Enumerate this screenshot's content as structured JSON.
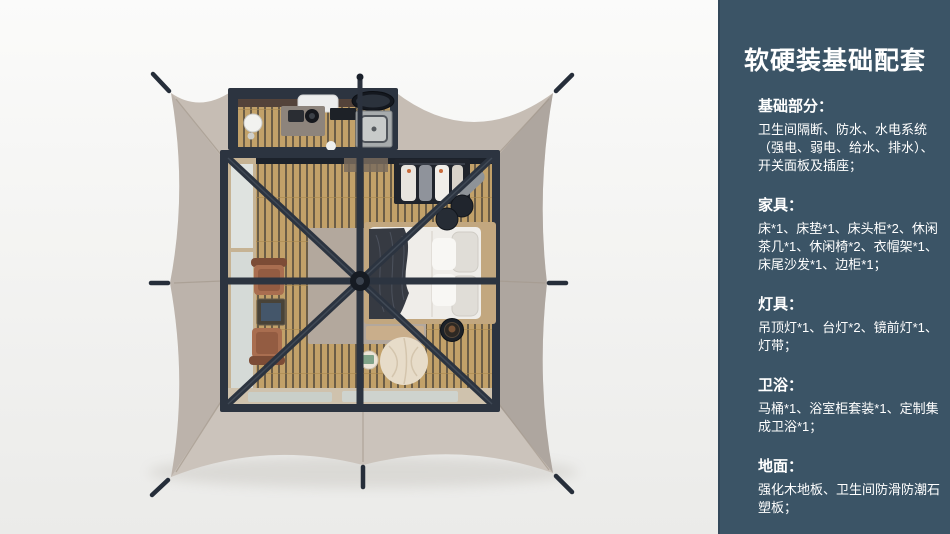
{
  "colors": {
    "sidebar_bg": "#3b5466",
    "sidebar_text": "#ffffff",
    "page_bg_top": "#fbfbfa",
    "page_bg_bottom": "#ebebe9",
    "canopy": "#c6bdb4",
    "canopy_shade": "#a9a09d",
    "frame": "#2c3440",
    "wood_floor": "#c2a169",
    "rug": "#b3a89d",
    "bed": "#efede9",
    "chair": "#a96e50",
    "pouf": "#e7dcc9",
    "glass": "#d8dedb",
    "stake": "#262e3a"
  },
  "scene": {
    "type": "top-down 3d floor plan rendering of a safari glamping tent",
    "elements": [
      "tent-canopy",
      "guy-line-stakes",
      "bathroom-annex",
      "main-room",
      "bed",
      "clothes-rack",
      "lounge-chairs",
      "tea-table",
      "bean-bag-pouf",
      "side-tables",
      "rug",
      "wood-slat-floor",
      "entrance-mats",
      "frame-beams",
      "center-pole"
    ]
  },
  "sidebar": {
    "title": "软硬装基础配套",
    "sections": [
      {
        "heading": "基础部分：",
        "body": [
          "卫生间隔断、防水、水电系统",
          "（强电、弱电、给水、排水）、",
          "开关面板及插座；"
        ]
      },
      {
        "heading": "家具：",
        "body": [
          "床*1、床垫*1、床头柜*2、休闲",
          "茶几*1、休闲椅*2、衣帽架*1、",
          "床尾沙发*1、边柜*1；"
        ]
      },
      {
        "heading": "灯具：",
        "body": [
          "吊顶灯*1、台灯*2、镜前灯*1、",
          "灯带；"
        ]
      },
      {
        "heading": "卫浴：",
        "body": [
          "马桶*1、浴室柜套装*1、定制集",
          "成卫浴*1；"
        ]
      },
      {
        "heading": "地面：",
        "body": [
          "强化木地板、卫生间防滑防潮石",
          "塑板；"
        ]
      }
    ]
  }
}
